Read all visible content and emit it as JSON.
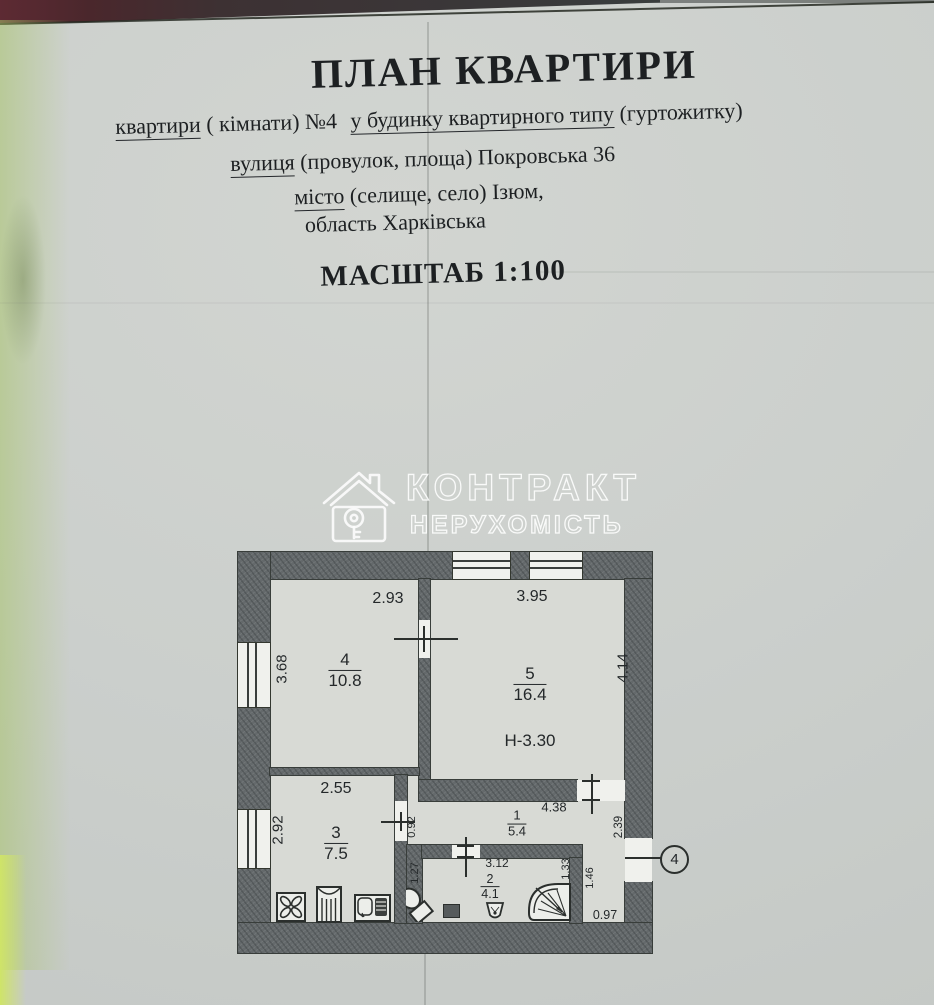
{
  "document": {
    "title": "ПЛАН КВАРТИРИ",
    "line_apartment": {
      "label_u": "квартири",
      "mid": " ( кімнати) №4",
      "building_u": "у будинку квартирного типу",
      "tail": " (гуртожитку)"
    },
    "line_street": {
      "label_u": "вулиця",
      "value": " (провулок, площа) Покровська 36"
    },
    "line_city": {
      "label_u": "місто",
      "value": " (селище, село) Ізюм,"
    },
    "line_region": "область Харківська",
    "scale": "МАСШТАБ 1:100"
  },
  "watermark": {
    "icon": "house-key-icon",
    "line1": "КОНТРАКТ",
    "line2": "НЕРУХОМІСТЬ"
  },
  "plan": {
    "rooms": {
      "room4": {
        "number": "4",
        "area": "10.8",
        "dim_top": "2.93",
        "dim_left": "3.68"
      },
      "room5": {
        "number": "5",
        "area": "16.4",
        "dim_top": "3.95",
        "dim_right": "4.14",
        "ceiling": "Н-3.30"
      },
      "room3": {
        "number": "3",
        "area": "7.5",
        "dim_top": "2.55",
        "dim_left": "2.92"
      },
      "room1": {
        "number": "1",
        "area": "5.4",
        "dim_top": "4.38",
        "dim_left": "0.92",
        "dim_right": "2.39"
      },
      "room2": {
        "number": "2",
        "area": "4.1",
        "dim_top": "3.12",
        "dim_left": "1.27",
        "dim_right": "1.33",
        "dim_outer_right": "1.46",
        "dim_bottom": "0.97"
      }
    },
    "entrance_label": "4",
    "fixtures": [
      "stove-icon",
      "kitchen-column-icon",
      "kitchen-sink-icon",
      "toilet-icon",
      "washing-machine-icon",
      "washbasin-icon",
      "corner-bath-icon"
    ]
  }
}
